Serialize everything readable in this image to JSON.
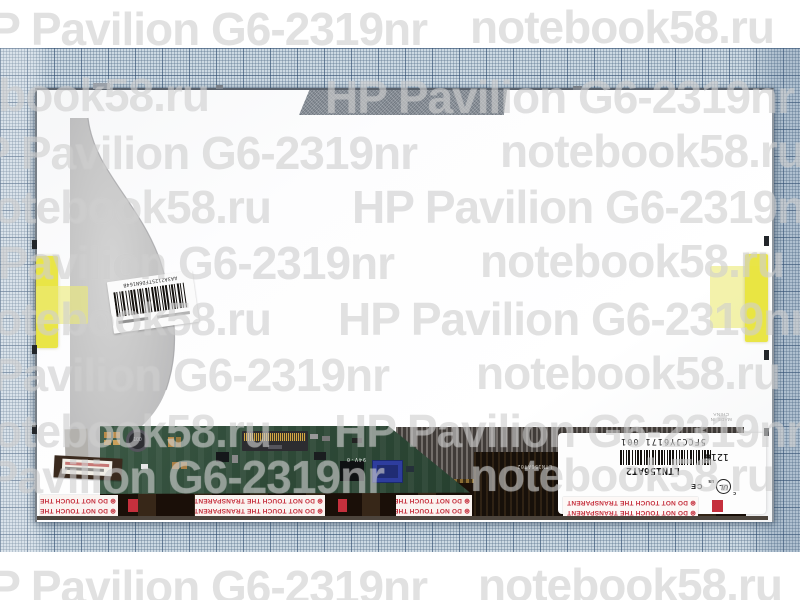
{
  "watermark": {
    "brand": "HP Pavilion G6-2319nr",
    "site": "notebook58.ru",
    "items": [
      {
        "text": "brand",
        "x": -42,
        "y": 2
      },
      {
        "text": "site",
        "x": 470,
        "y": 0
      },
      {
        "text": "site",
        "x": -95,
        "y": 68
      },
      {
        "text": "brand",
        "x": 325,
        "y": 70
      },
      {
        "text": "brand",
        "x": -52,
        "y": 126
      },
      {
        "text": "site",
        "x": 500,
        "y": 124
      },
      {
        "text": "site",
        "x": -33,
        "y": 180
      },
      {
        "text": "brand",
        "x": 352,
        "y": 180
      },
      {
        "text": "brand",
        "x": -75,
        "y": 236
      },
      {
        "text": "site",
        "x": 480,
        "y": 234
      },
      {
        "text": "site",
        "x": -33,
        "y": 292
      },
      {
        "text": "brand",
        "x": 338,
        "y": 292
      },
      {
        "text": "brand",
        "x": -80,
        "y": 348
      },
      {
        "text": "site",
        "x": 476,
        "y": 346
      },
      {
        "text": "site",
        "x": -33,
        "y": 404
      },
      {
        "text": "brand",
        "x": 334,
        "y": 404
      },
      {
        "text": "brand",
        "x": -85,
        "y": 450
      },
      {
        "text": "site",
        "x": 470,
        "y": 448
      },
      {
        "text": "brand",
        "x": -42,
        "y": 560
      },
      {
        "text": "site",
        "x": 478,
        "y": 558
      }
    ]
  },
  "warning": {
    "symbol": "⊛",
    "text": "DO NOT TOUCH THE TRANSPARENT"
  },
  "panel_label": {
    "model": "LTN156AT2",
    "serial": "5FCCJY6171 001",
    "date_code": "1216",
    "made_in": "MADE IN CHINA",
    "cert_c": "c",
    "cert_ul": "UL",
    "cert_us": "us",
    "cert_ce": "CE",
    "barcode_pattern": "2112112212112122112112211221211211212212112112122112112211212112"
  },
  "barcode_sticker": {
    "code": "AA3A2125TFD6N164B",
    "pattern": "21121122121121221121122112212112112122112112211212"
  },
  "board": {
    "inductor_marking": "100",
    "silkscreen": "94V-0",
    "chip_marking": "LTN156AT02"
  },
  "colors": {
    "tape_yellow": "#e8e43c",
    "pcb_green": "#2f4a38",
    "warning_red": "#c5303d",
    "graph_paper_blue": "#ccd9e3"
  }
}
